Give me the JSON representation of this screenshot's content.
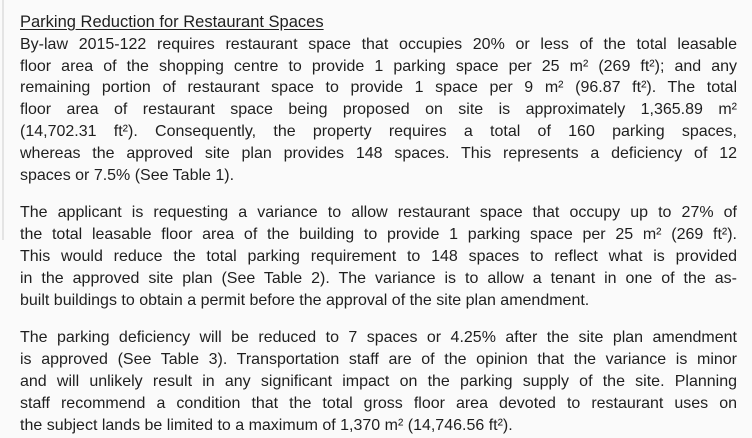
{
  "document": {
    "heading": "Parking Reduction for Restaurant Spaces",
    "paragraphs": [
      {
        "lines": [
          "By-law 2015-122 requires restaurant space that occupies 20% or less of the total leasable",
          "floor area of the shopping centre to provide 1 parking space per 25 m² (269 ft²); and any",
          "remaining portion of restaurant space to provide 1 space per 9 m² (96.87 ft²). The total",
          "floor area of restaurant space being proposed on site is approximately 1,365.89 m²",
          "(14,702.31 ft²). Consequently, the property requires a total of 160 parking spaces,",
          "whereas the approved site plan provides 148 spaces.  This represents a deficiency of 12",
          "spaces or 7.5% (See Table 1)."
        ]
      },
      {
        "lines": [
          "The applicant is requesting a variance to allow restaurant space that occupy up to 27% of",
          "the total leasable floor area of the building to provide 1 parking space per 25 m² (269 ft²).",
          "This would reduce the total parking requirement to 148 spaces to reflect what is provided",
          "in the approved site plan (See Table 2). The variance is to allow a tenant in one of the as-",
          "built buildings to obtain a permit before the approval of the site plan amendment."
        ]
      },
      {
        "lines": [
          "The parking deficiency will be reduced to 7 spaces or 4.25% after the site plan amendment",
          "is approved (See Table 3). Transportation staff are of the opinion that the variance is minor",
          "and will unlikely result in any significant impact on the parking supply of the site. Planning",
          "staff recommend a condition that the total gross floor area devoted to restaurant uses on",
          "the subject lands be limited to a maximum of 1,370 m² (14,746.56 ft²)."
        ]
      }
    ]
  },
  "colors": {
    "text": "#1f1f1f",
    "background": "#fafafa"
  }
}
